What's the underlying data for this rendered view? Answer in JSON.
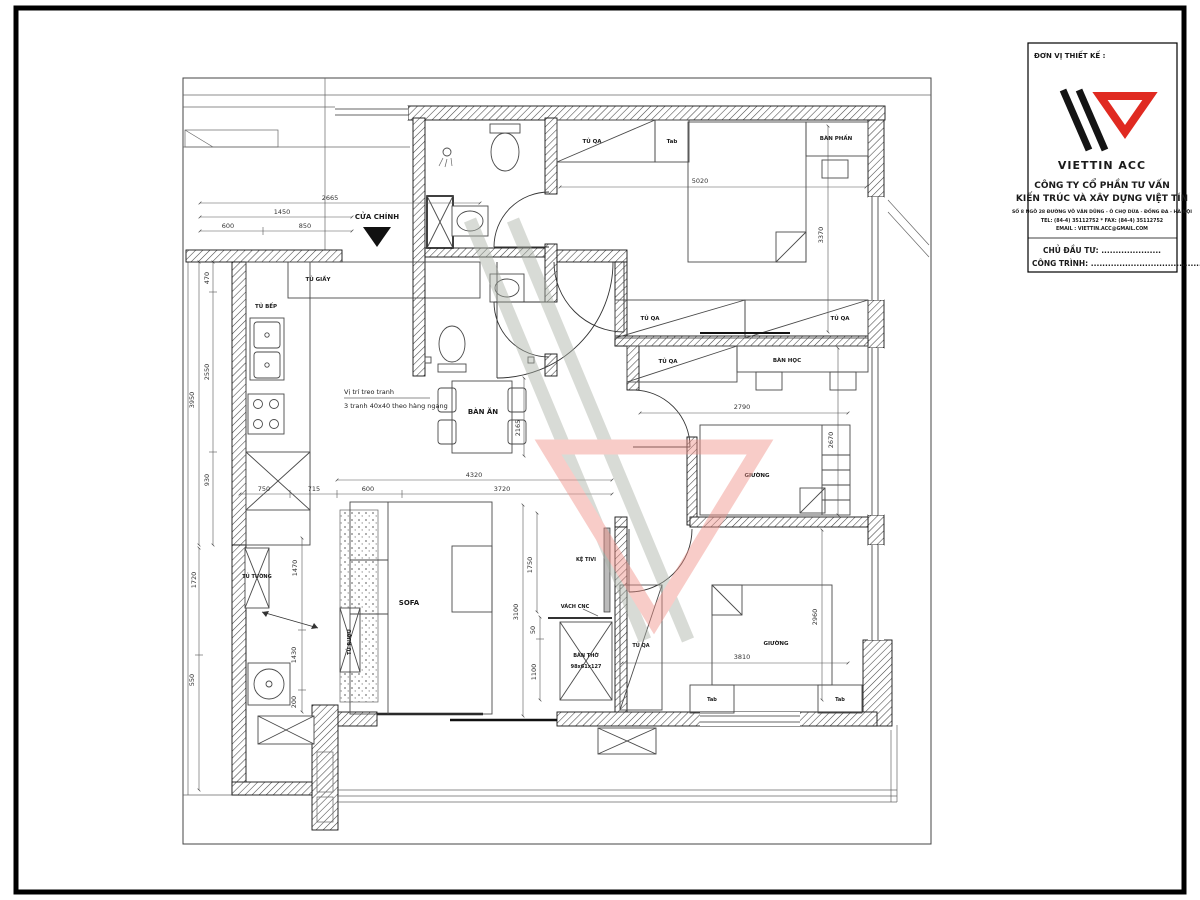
{
  "title_block": {
    "designer_label": "ĐƠN VỊ THIẾT KẾ :",
    "logo_name": "VIETTIN ACC",
    "company_line1": "CÔNG TY CỔ PHẦN TƯ VẤN",
    "company_line2": "KIẾN TRÚC VÀ XÂY DỰNG VIỆT TÍN",
    "address_line": "SỐ 8 NGÕ 28 ĐƯỜNG VÕ VĂN DŨNG - Ô CHỢ DỪA - ĐỐNG ĐA - HÀ NỘI",
    "tel_line": "TEL: (84-4) 35112752 * FAX: (84-4) 35112752",
    "email_line": "EMAIL : VIETTIN.ACC@GMAIL.COM",
    "investor_line": "CHỦ ĐẦU TƯ: .....................",
    "project_line": "CÔNG TRÌNH: ...............................................",
    "colors": {
      "logo_red": "#e02a21",
      "logo_black": "#141414"
    }
  },
  "plan": {
    "labels": {
      "cua_chinh": "CỬA CHÍNH",
      "tu_giay": "TỦ GIẦY",
      "tu_bep": "TỦ BẾP",
      "tu_tuong": "TỦ TƯỜNG",
      "tu_ruou": "TỦ RƯỢU",
      "sofa": "SOFA",
      "ban_an": "BÀN ĂN",
      "note1": "Vị trí treo tranh",
      "note2": "3 tranh 40x40 theo hàng ngang",
      "ke_tivi": "KỆ TIVI",
      "vach_cnc": "VÁCH CNC",
      "ban_tho1": "BÀN THỜ",
      "ban_tho2": "98x61x127",
      "tu_qa": "TỦ QA",
      "tab": "Tab",
      "ban_phan": "BÀN PHẤN",
      "ban_hoc": "BÀN HỌC",
      "giuong": "GIƯỜNG"
    },
    "dims": {
      "top_total": "2665",
      "top_1450": "1450",
      "top_600": "600",
      "top_850": "850",
      "left_3950": "3950",
      "left_470": "470",
      "left_2550": "2550",
      "left_930": "930",
      "left_1720": "1720",
      "left_550": "550",
      "mid_750": "750",
      "mid_715": "715",
      "mid_600": "600",
      "mid_4320": "4320",
      "mid_3720": "3720",
      "dining_2165": "2165",
      "hall_1750": "1750",
      "hall_3100": "3100",
      "hall_50": "50",
      "hall_1100": "1100",
      "util_1470": "1470",
      "util_1430": "1430",
      "util_200": "200",
      "bed1_5020": "5020",
      "bed1_3370": "3370",
      "bed2_2790": "2790",
      "bed2_2670": "2670",
      "bed3_3810": "3810",
      "bed3_2960": "2960"
    }
  }
}
